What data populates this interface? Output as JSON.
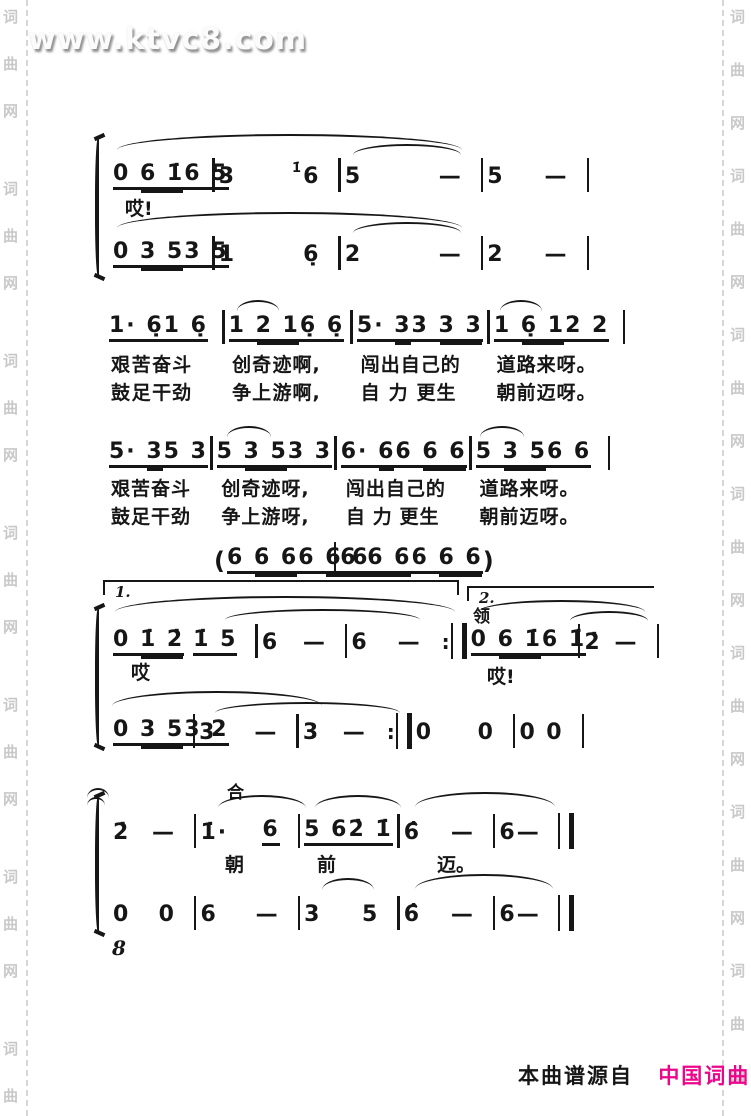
{
  "page": {
    "watermark": "www.ktvc8.com",
    "side_watermark": [
      "词",
      "曲",
      "网"
    ],
    "page_number": "8",
    "footer": {
      "prefix": "本曲谱源自",
      "brand": "中国词曲网"
    },
    "colors": {
      "ink": "#161616",
      "brand_pink": "#ec068c",
      "watermark_gray": "#c9c9c9"
    }
  },
  "score": {
    "labels": {
      "ending1": "1.",
      "ending2": "2.",
      "lead": "领",
      "tutti": "合"
    },
    "s1": {
      "lyric": "哎!",
      "v1": [
        {
          "c": [
            [
              {
                "t": "0 ",
                "u": 1
              },
              {
                "t": "6 1̇",
                "u": 2
              }
            ],
            [
              {
                "t": "6 5",
                "u": 1
              }
            ]
          ]
        },
        {
          "c": [
            [
              {
                "t": "3"
              }
            ],
            [
              {
                "t": "1̇",
                "g": 1
              },
              {
                "t": "6"
              }
            ]
          ]
        },
        {
          "c": [
            [
              {
                "t": "5"
              }
            ],
            [
              {
                "t": "—"
              }
            ]
          ]
        },
        {
          "c": [
            [
              {
                "t": "5"
              }
            ],
            [
              {
                "t": "—"
              }
            ]
          ]
        }
      ],
      "v2": [
        {
          "c": [
            [
              {
                "t": "0 ",
                "u": 1
              },
              {
                "t": "3 5",
                "u": 2
              }
            ],
            [
              {
                "t": "3 5",
                "u": 1
              }
            ]
          ]
        },
        {
          "c": [
            [
              {
                "t": "1"
              }
            ],
            [
              {
                "t": "6̣"
              }
            ]
          ]
        },
        {
          "c": [
            [
              {
                "t": "2"
              }
            ],
            [
              {
                "t": "—"
              }
            ]
          ]
        },
        {
          "c": [
            [
              {
                "t": "2"
              }
            ],
            [
              {
                "t": "—"
              }
            ]
          ]
        }
      ]
    },
    "s2": {
      "notes": [
        {
          "c": [
            [
              {
                "t": "1· 6̣",
                "u": 1
              }
            ],
            [
              {
                "t": "1 6̣",
                "u": 1
              }
            ]
          ]
        },
        {
          "c": [
            [
              {
                "t": "1 ",
                "u": 1
              },
              {
                "t": "2 1",
                "u": 2
              }
            ],
            [
              {
                "t": "6̣ 6̣",
                "u": 1
              }
            ]
          ]
        },
        {
          "c": [
            [
              {
                "t": "5· ",
                "u": 1
              },
              {
                "t": "3",
                "u": 2
              }
            ],
            [
              {
                "t": "3 ",
                "u": 1
              },
              {
                "t": "3 3",
                "u": 2
              }
            ]
          ]
        },
        {
          "c": [
            [
              {
                "t": "1 ",
                "u": 1
              },
              {
                "t": "6̣ 1",
                "u": 2
              }
            ],
            [
              {
                "t": "2 2",
                "u": 1
              }
            ]
          ]
        }
      ],
      "l1": [
        [
          "艰",
          "苦",
          "奋斗"
        ],
        [
          "创奇",
          "迹啊,"
        ],
        [
          "闯",
          "出",
          "自己的"
        ],
        [
          "道路",
          "来呀。"
        ]
      ],
      "l2": [
        [
          "鼓",
          "足",
          "干劲"
        ],
        [
          "争上",
          "游啊,"
        ],
        [
          "自",
          "力",
          "更生"
        ],
        [
          "朝前",
          "迈呀。"
        ]
      ]
    },
    "s3": {
      "notes": [
        {
          "c": [
            [
              {
                "t": "5· ",
                "u": 1
              },
              {
                "t": "3",
                "u": 2
              }
            ],
            [
              {
                "t": "5 3",
                "u": 1
              }
            ]
          ]
        },
        {
          "c": [
            [
              {
                "t": "5 ",
                "u": 1
              },
              {
                "t": "3 5",
                "u": 2
              }
            ],
            [
              {
                "t": "3 3",
                "u": 1
              }
            ]
          ]
        },
        {
          "c": [
            [
              {
                "t": "6· ",
                "u": 1
              },
              {
                "t": "6",
                "u": 2
              }
            ],
            [
              {
                "t": "6 ",
                "u": 1
              },
              {
                "t": "6 6",
                "u": 2
              }
            ]
          ]
        },
        {
          "c": [
            [
              {
                "t": "5 ",
                "u": 1
              },
              {
                "t": "3 5",
                "u": 2
              }
            ],
            [
              {
                "t": "6 6",
                "u": 1
              }
            ]
          ]
        }
      ],
      "l1": [
        [
          "艰",
          "苦",
          "奋斗"
        ],
        [
          "创奇",
          "迹呀,"
        ],
        [
          "闯",
          "出",
          "自己的"
        ],
        [
          "道路",
          "来呀。"
        ]
      ],
      "l2": [
        [
          "鼓",
          "足",
          "干劲"
        ],
        [
          "争上",
          "游呀,"
        ],
        [
          "自",
          "力",
          "更生"
        ],
        [
          "朝前",
          "迈呀。"
        ]
      ]
    },
    "interlude": [
      {
        "c": [
          [
            {
              "t": "(",
              "p": 1
            }
          ],
          [
            {
              "t": "6 ",
              "u": 1
            },
            {
              "t": "6 6",
              "u": 2
            }
          ],
          [
            {
              "t": "6 ",
              "u": 1
            },
            {
              "t": "6 6",
              "u": 2
            }
          ]
        ]
      },
      {
        "c": [
          [
            {
              "t": "6 ",
              "u": 1
            },
            {
              "t": "6 6",
              "u": 2
            }
          ],
          [
            {
              "t": "6 ",
              "u": 1
            },
            {
              "t": "6 6",
              "u": 2
            }
          ],
          [
            {
              "t": ")",
              "p": 1
            }
          ]
        ],
        "e": "none"
      }
    ],
    "s4": {
      "lyric1": "哎",
      "lyric2": "哎!",
      "v1": [
        {
          "c": [
            [
              {
                "t": "0 ",
                "u": 1
              },
              {
                "t": "1̇ 2̇",
                "u": 2
              }
            ],
            [
              {
                "t": "1̇ 5",
                "u": 1
              }
            ]
          ]
        },
        {
          "c": [
            [
              {
                "t": "6"
              }
            ],
            [
              {
                "t": "—"
              }
            ]
          ]
        },
        {
          "c": [
            [
              {
                "t": "6"
              }
            ],
            [
              {
                "t": "—"
              }
            ]
          ],
          "e": "repeat"
        },
        {
          "c": [
            [
              {
                "t": "0 ",
                "u": 1
              },
              {
                "t": "6 1̇",
                "u": 2
              }
            ],
            [
              {
                "t": "6 1̇",
                "u": 1
              }
            ]
          ]
        },
        {
          "c": [
            [
              {
                "t": "2̇"
              }
            ],
            [
              {
                "t": "—"
              }
            ]
          ]
        }
      ],
      "v2": [
        {
          "c": [
            [
              {
                "t": "0 ",
                "u": 1
              },
              {
                "t": "3 5",
                "u": 2
              }
            ],
            [
              {
                "t": "3 2",
                "u": 1
              }
            ]
          ]
        },
        {
          "c": [
            [
              {
                "t": "3"
              }
            ],
            [
              {
                "t": "—"
              }
            ]
          ]
        },
        {
          "c": [
            [
              {
                "t": "3"
              }
            ],
            [
              {
                "t": "—"
              }
            ]
          ],
          "e": "repeat"
        },
        {
          "c": [
            [
              {
                "t": "0"
              }
            ],
            [
              {
                "t": "0"
              }
            ]
          ]
        },
        {
          "c": [
            [
              {
                "t": "0"
              }
            ],
            [
              {
                "t": "0"
              }
            ]
          ]
        }
      ]
    },
    "s5": {
      "lyrics": [
        "朝",
        "前",
        "迈。"
      ],
      "v1": [
        {
          "c": [
            [
              {
                "t": "2̇"
              }
            ],
            [
              {
                "t": "—"
              }
            ]
          ]
        },
        {
          "c": [
            [
              {
                "t": "1̇·"
              }
            ],
            [
              {
                "t": "6",
                "u": 1
              }
            ]
          ]
        },
        {
          "c": [
            [
              {
                "t": "5 6",
                "u": 1
              }
            ],
            [
              {
                "t": "2̇ 1̇",
                "u": 1
              }
            ]
          ]
        },
        {
          "c": [
            [
              {
                "t": "6̂"
              }
            ],
            [
              {
                "t": "—"
              }
            ]
          ]
        },
        {
          "c": [
            [
              {
                "t": "6"
              }
            ],
            [
              {
                "t": "—"
              }
            ]
          ],
          "e": "final"
        }
      ],
      "v2": [
        {
          "c": [
            [
              {
                "t": "0"
              }
            ],
            [
              {
                "t": "0"
              }
            ]
          ]
        },
        {
          "c": [
            [
              {
                "t": "6"
              }
            ],
            [
              {
                "t": "—"
              }
            ]
          ]
        },
        {
          "c": [
            [
              {
                "t": "3"
              }
            ],
            [
              {
                "t": "5"
              }
            ]
          ]
        },
        {
          "c": [
            [
              {
                "t": "6̂"
              }
            ],
            [
              {
                "t": "—"
              }
            ]
          ]
        },
        {
          "c": [
            [
              {
                "t": "6"
              }
            ],
            [
              {
                "t": "—"
              }
            ]
          ],
          "e": "final"
        }
      ]
    }
  }
}
